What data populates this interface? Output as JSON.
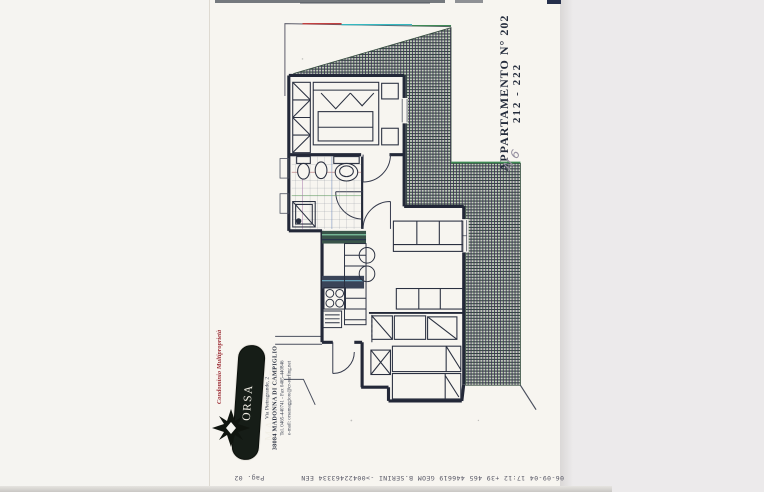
{
  "document": {
    "apartment_label_line1": "APPARTAMENTO N° 202",
    "apartment_label_line2": "212 - 222",
    "handwritten_note": "N 6",
    "fax_header": "06-09-04  17:12   +39 465 446619    GEOM B.SERINI   ->00422463334  EEN",
    "page_number_note": "Pag. 02"
  },
  "logo": {
    "tagline": "Condominio Multiproprietà",
    "name": "ORSA MAGGIORE",
    "address_line1": "Via Pietragrande, 2",
    "address_line2": "38084 MADONNA DI CAMPIGLIO",
    "address_line3": "Tel. 0465-440741  -  Fax 0465-440846",
    "address_line4": "e-mail: orsamaggiore@cr-surfing.net"
  },
  "colors": {
    "ink": "#232838",
    "hatch_green": "#2c4638",
    "hatch_purple": "#3d3356",
    "logo_pill": "#161d17",
    "tagline_red": "#9e3038",
    "artifact_cyan": "#35b8c0",
    "artifact_red": "#c24040",
    "artifact_green": "#3f8a55"
  }
}
